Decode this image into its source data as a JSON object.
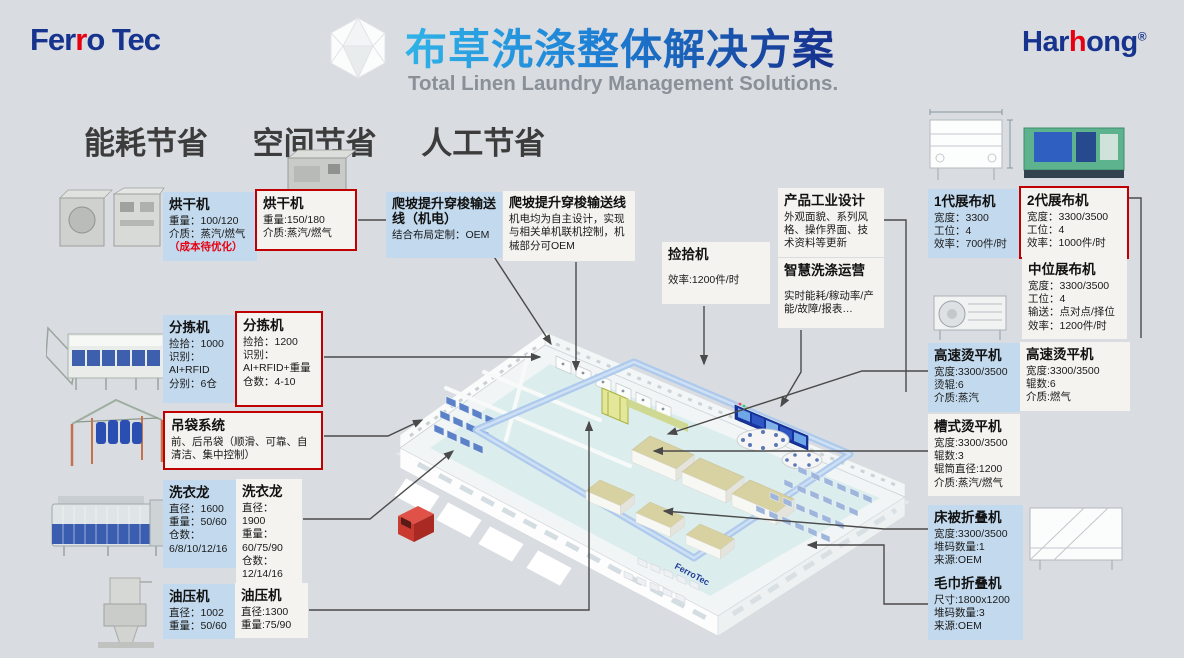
{
  "header": {
    "logo_left": {
      "pre": "Fer",
      "accent": "r",
      "post": "o Tec"
    },
    "logo_right": {
      "pre": "Har",
      "accent": "h",
      "post": "ong",
      "reg": "®"
    },
    "title_zh": "布草洗涤整体解决方案",
    "title_en": "Total Linen Laundry Management Solutions."
  },
  "benefits": {
    "items": [
      "能耗节省",
      "空间节省",
      "人工节省"
    ]
  },
  "callouts": [
    {
      "title": "烘干机",
      "body": "重量：100/120\n介质：蒸汽/燃气",
      "note": "（成本待优化）",
      "variant": "blue"
    },
    {
      "title": "烘干机",
      "body": "重量:150/180\n介质:蒸汽/燃气",
      "variant": "white-red"
    },
    {
      "title": "爬坡提升穿梭输送线（机电）",
      "body": "结合布局定制：OEM",
      "variant": "blue"
    },
    {
      "title": "爬坡提升穿梭输送线",
      "body": "机电均为自主设计，实现与相关单机联机控制，机械部分可OEM",
      "variant": "white"
    },
    {
      "title": "捡拾机",
      "body": "效率:1200件/时",
      "variant": "white"
    },
    {
      "title": "产品工业设计",
      "body": "外观面貌、系列风格、操作界面、技术资料等更新",
      "variant": "white"
    },
    {
      "title": "智慧洗涤运营",
      "body": "实时能耗/稼动率/产能/故障/报表…",
      "variant": "white"
    },
    {
      "title": "分拣机",
      "body": "捡拾：1000\n识别：\nAI+RFID\n分别：6仓",
      "variant": "blue"
    },
    {
      "title": "分拣机",
      "body": "捡拾：1200\n识别：\nAI+RFID+重量\n仓数：4-10",
      "variant": "white-red"
    },
    {
      "title": "吊袋系统",
      "body": "前、后吊袋（顺滑、可靠、自清洁、集中控制）",
      "variant": "white-red"
    },
    {
      "title": "洗衣龙",
      "body": "直径：1600\n重量：50/60\n仓数：\n6/8/10/12/16",
      "variant": "blue"
    },
    {
      "title": "洗衣龙",
      "body": "直径：1900\n重量：\n60/75/90\n仓数：\n12/14/16",
      "variant": "white"
    },
    {
      "title": "油压机",
      "body": "直径：1002\n重量：50/60",
      "variant": "blue"
    },
    {
      "title": "油压机",
      "body": "直径:1300\n重量:75/90",
      "variant": "white"
    },
    {
      "title": "1代展布机",
      "body": "宽度：3300\n工位：4\n效率：700件/时",
      "variant": "blue"
    },
    {
      "title": "2代展布机",
      "body": "宽度：3300/3500\n工位：4\n效率：1000件/时",
      "variant": "white-red"
    },
    {
      "title": "中位展布机",
      "body": "宽度：3300/3500\n工位：4\n输送：点对点/择位\n效率：1200件/时",
      "variant": "white"
    },
    {
      "title": "高速烫平机",
      "body": "宽度:3300/3500\n烫辊:6\n介质:蒸汽",
      "variant": "blue"
    },
    {
      "title": "高速烫平机",
      "body": "宽度:3300/3500\n辊数:6\n介质:燃气",
      "variant": "white"
    },
    {
      "title": "槽式烫平机",
      "body": "宽度:3300/3500\n辊数:3\n辊筒直径:1200\n介质:蒸汽/燃气",
      "variant": "white"
    },
    {
      "title": "床被折叠机",
      "body": "宽度:3300/3500\n堆码数量:1\n来源:OEM",
      "variant": "blue"
    },
    {
      "title": "毛巾折叠机",
      "body": "尺寸:1800x1200\n堆码数量:3\n来源:OEM",
      "variant": "blue"
    }
  ],
  "factory": {
    "label": "FerroTec"
  },
  "icons": {
    "logo_mark": "polyhedron-icon"
  },
  "colors": {
    "background": "#d9dce1",
    "accent_red": "#e60012",
    "brand_blue": "#16338e",
    "title_gradient_start": "#2fb3e8",
    "title_gradient_end": "#162f8c",
    "callout_blue": "#c3daee",
    "callout_white": "#f4f3ef",
    "red_border": "#cc0000"
  }
}
